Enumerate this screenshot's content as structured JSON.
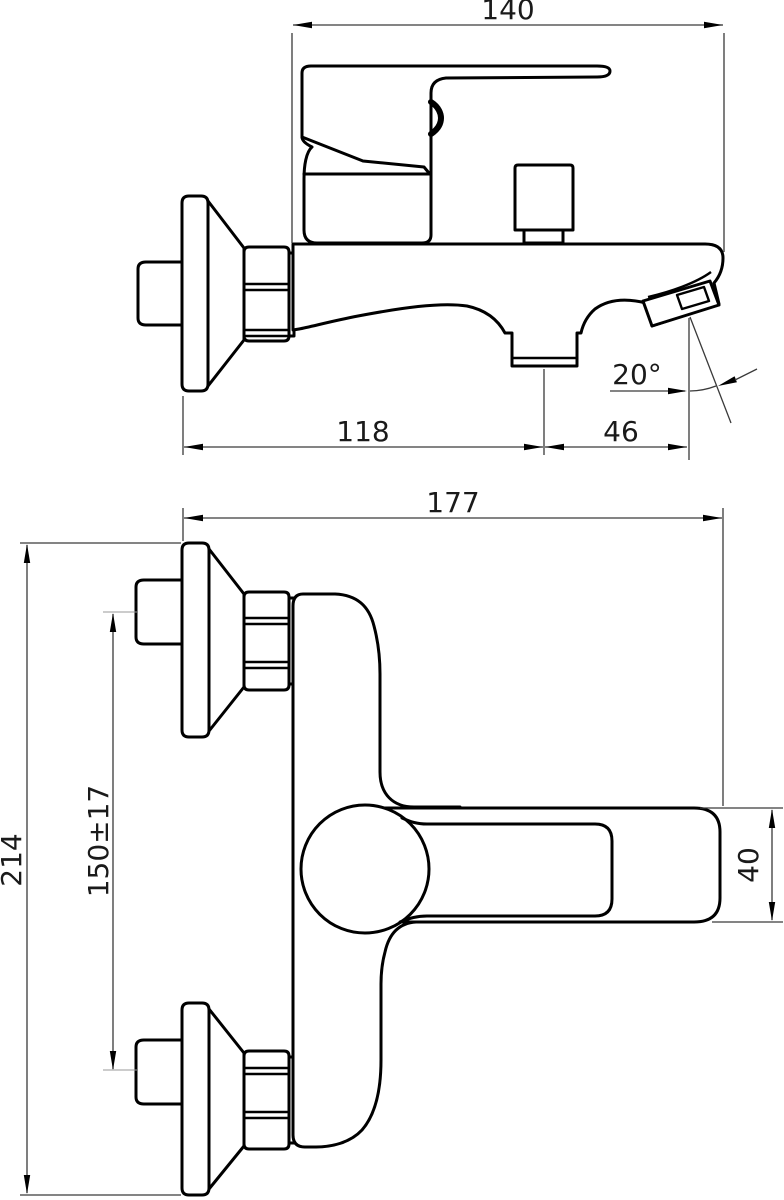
{
  "drawing": {
    "subject": "wall-mounted-bath-mixer-tap",
    "colors": {
      "background": "#ffffff",
      "part_outline": "#000000",
      "dimension_lines": "#3a3a3a",
      "centerline": "#999999",
      "text": "#1a1a1a"
    },
    "views": {
      "side_view": {
        "dimensions": {
          "spout_depth": "140",
          "wall_to_outlet": "118",
          "outlet_to_spout_tip": "46",
          "spout_angle": "20°"
        }
      },
      "front_view": {
        "dimensions": {
          "overall_depth": "177",
          "overall_height": "214",
          "connection_centres": "150±17",
          "spout_height": "40"
        }
      }
    }
  }
}
